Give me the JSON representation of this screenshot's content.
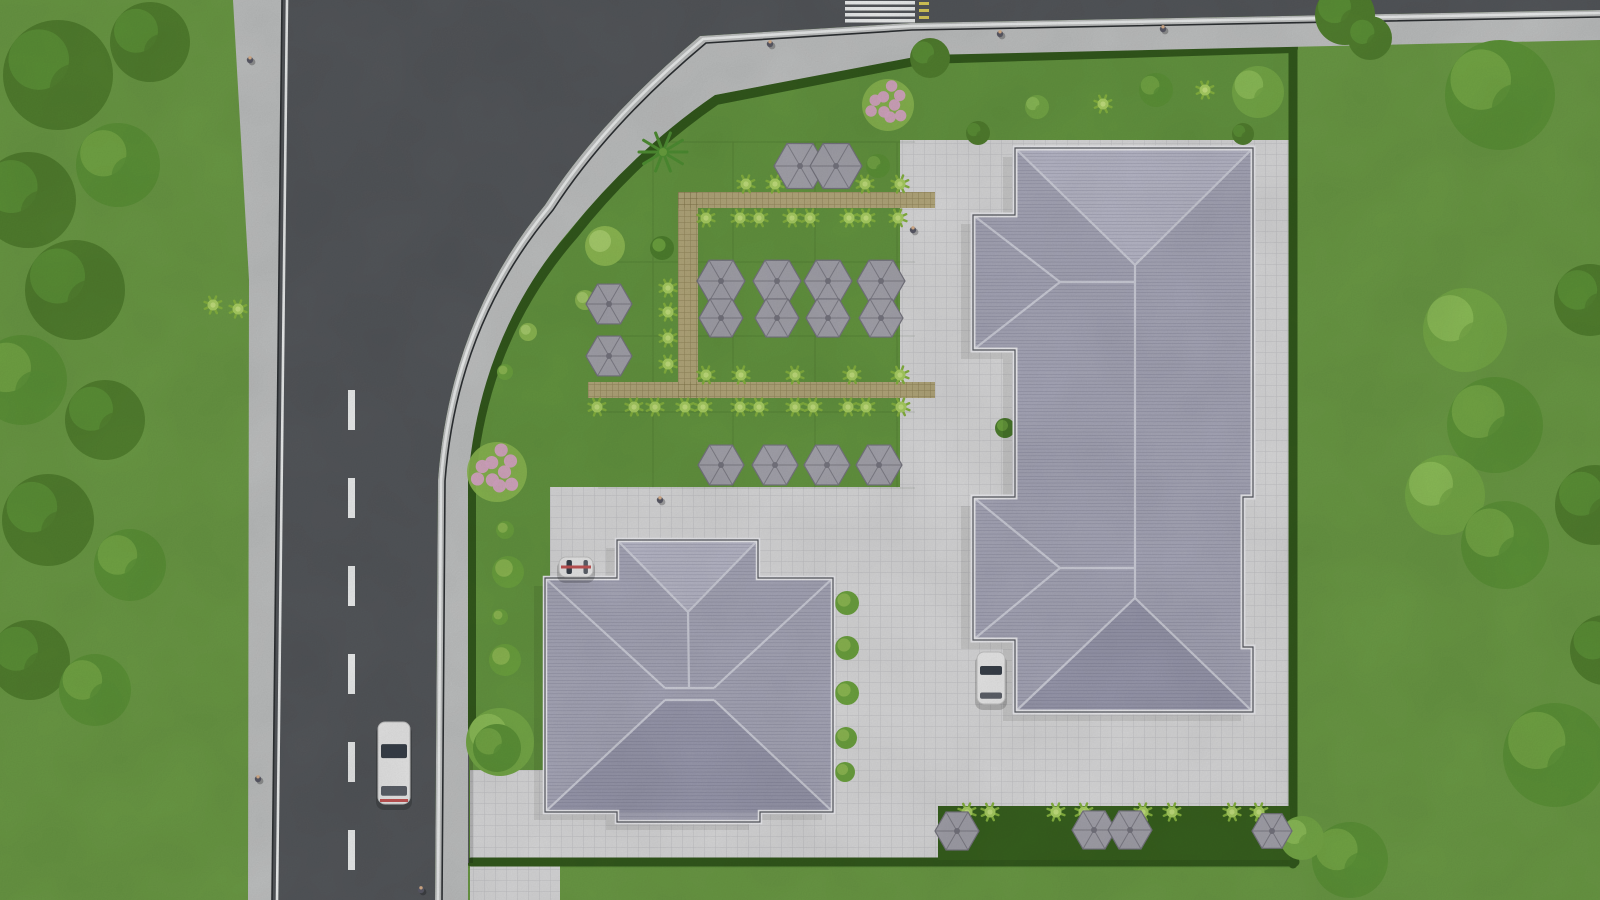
{
  "scene": {
    "description": "Aerial top-down 3D architectural rendering of a residential site plan: an L-shaped asphalt road with sidewalks on the left and top, a hedged property containing a large apartment building (top right), a smaller building (bottom centre), a paved courtyard, a community garden with hexagonal pavilions and boardwalk paths, a planter strip, parked and moving cars, and surrounding lawns with trees.",
    "palette": {
      "baseLawn": "#6b9a45",
      "propertyLawn": "#649540",
      "asphalt": "#54575b",
      "sidewalk": "#bfc1c1",
      "curb": "#2d3033",
      "lineWhite": "#eceeee",
      "lineYellow": "#d9ca5a",
      "hedge": "#33591d",
      "pavement": "#d9d9da",
      "pavementLine": "#c6c6c9",
      "planter": "#38611f",
      "boardwalk": "#b4a87c",
      "boardwalkLine": "#8f845a",
      "roof": "#a8a8b9",
      "roofLight": "#b9b9c9",
      "roofDark": "#9a9aae",
      "roofLine": "#cdced9",
      "eave": "#ebebef",
      "wallLine": "#55575e",
      "hexFill": "#a4a3ac",
      "hexEdge": "#76757f",
      "shrub": "#a9cf63",
      "shrubCore": "#c3e07e",
      "bush": "#6ca23f",
      "bushLight": "#8cb852",
      "tree": "#527f2f",
      "treeMid": "#5d9338",
      "treeLight": "#75a847",
      "pink": "#d9a8c6",
      "fence": "#5a5c60",
      "carBody": "#eaeaea",
      "carGlass": "#39404a",
      "carRed": "#c25555",
      "person": "#5a5a66",
      "personHead": "#d8b08c"
    },
    "counts": {
      "hexagon_pavilions": 20,
      "cars": 3,
      "pedestrians": 8
    },
    "trees": [
      [
        58,
        75,
        55,
        "d"
      ],
      [
        150,
        42,
        40,
        "d"
      ],
      [
        28,
        200,
        48,
        "d"
      ],
      [
        118,
        165,
        42,
        "m"
      ],
      [
        75,
        290,
        50,
        "d"
      ],
      [
        22,
        380,
        45,
        "m"
      ],
      [
        105,
        420,
        40,
        "d"
      ],
      [
        48,
        520,
        46,
        "d"
      ],
      [
        130,
        565,
        36,
        "m"
      ],
      [
        30,
        660,
        40,
        "d"
      ],
      [
        95,
        690,
        36,
        "m"
      ],
      [
        1500,
        95,
        55,
        "m"
      ],
      [
        1345,
        15,
        30,
        "d"
      ],
      [
        1370,
        38,
        22,
        "d"
      ],
      [
        1465,
        330,
        42,
        "l"
      ],
      [
        1495,
        425,
        48,
        "m"
      ],
      [
        1445,
        495,
        40,
        "l"
      ],
      [
        1505,
        545,
        44,
        "m"
      ],
      [
        1590,
        300,
        36,
        "d"
      ],
      [
        1595,
        505,
        40,
        "d"
      ],
      [
        1555,
        755,
        52,
        "m"
      ],
      [
        1605,
        650,
        35,
        "d"
      ],
      [
        1350,
        860,
        38,
        "m"
      ],
      [
        1302,
        838,
        22,
        "l"
      ],
      [
        1156,
        90,
        17,
        "m"
      ],
      [
        1258,
        92,
        26,
        "l"
      ],
      [
        1243,
        134,
        11,
        "d"
      ],
      [
        1037,
        107,
        12,
        "l"
      ],
      [
        978,
        133,
        12,
        "d"
      ],
      [
        930,
        58,
        20,
        "d"
      ],
      [
        878,
        166,
        12,
        "m"
      ],
      [
        500,
        742,
        34,
        "l"
      ],
      [
        497,
        748,
        24,
        "m"
      ]
    ],
    "shrubs": [
      [
        746,
        184
      ],
      [
        775,
        184
      ],
      [
        865,
        184
      ],
      [
        900,
        184
      ],
      [
        706,
        218
      ],
      [
        740,
        218
      ],
      [
        759,
        218
      ],
      [
        792,
        218
      ],
      [
        810,
        218
      ],
      [
        849,
        218
      ],
      [
        866,
        218
      ],
      [
        898,
        218
      ],
      [
        668,
        288
      ],
      [
        668,
        312
      ],
      [
        668,
        338
      ],
      [
        668,
        364
      ],
      [
        706,
        375
      ],
      [
        741,
        375
      ],
      [
        795,
        375
      ],
      [
        852,
        375
      ],
      [
        900,
        375
      ],
      [
        597,
        407
      ],
      [
        634,
        407
      ],
      [
        655,
        407
      ],
      [
        685,
        407
      ],
      [
        703,
        407
      ],
      [
        740,
        407
      ],
      [
        759,
        407
      ],
      [
        795,
        407
      ],
      [
        813,
        407
      ],
      [
        848,
        407
      ],
      [
        866,
        407
      ],
      [
        901,
        407
      ],
      [
        213,
        305
      ],
      [
        238,
        309
      ],
      [
        1103,
        104
      ],
      [
        1205,
        90
      ],
      [
        967,
        812
      ],
      [
        990,
        812
      ],
      [
        1056,
        812
      ],
      [
        1084,
        812
      ],
      [
        1143,
        812
      ],
      [
        1172,
        812
      ],
      [
        1232,
        812
      ],
      [
        1259,
        812
      ]
    ],
    "bushes": [
      [
        605,
        246,
        20,
        "l"
      ],
      [
        662,
        248,
        12,
        "d"
      ],
      [
        1005,
        428,
        10,
        "d"
      ],
      [
        847,
        603,
        12,
        "m"
      ],
      [
        847,
        648,
        12,
        "m"
      ],
      [
        847,
        693,
        12,
        "m"
      ],
      [
        846,
        738,
        11,
        "m"
      ],
      [
        845,
        772,
        10,
        "m"
      ],
      [
        505,
        530,
        9,
        "m"
      ],
      [
        508,
        572,
        16,
        "m"
      ],
      [
        500,
        617,
        8,
        "m"
      ],
      [
        505,
        660,
        16,
        "m"
      ],
      [
        585,
        300,
        10,
        "l"
      ],
      [
        528,
        332,
        9,
        "l"
      ],
      [
        505,
        372,
        8,
        "m"
      ]
    ],
    "pink_bushes": [
      [
        888,
        105,
        26
      ],
      [
        497,
        472,
        30
      ]
    ],
    "palms": [
      [
        663,
        152
      ]
    ],
    "hexagons": [
      [
        800,
        166,
        26
      ],
      [
        836,
        166,
        26
      ],
      [
        721,
        281,
        24
      ],
      [
        721,
        318,
        22
      ],
      [
        777,
        281,
        24
      ],
      [
        777,
        318,
        22
      ],
      [
        828,
        281,
        24
      ],
      [
        828,
        318,
        22
      ],
      [
        881,
        281,
        24
      ],
      [
        881,
        318,
        22
      ],
      [
        609,
        304,
        23
      ],
      [
        609,
        356,
        23
      ],
      [
        721,
        465,
        23
      ],
      [
        775,
        465,
        23
      ],
      [
        827,
        465,
        23
      ],
      [
        879,
        465,
        23
      ],
      [
        957,
        831,
        22
      ],
      [
        1094,
        830,
        22
      ],
      [
        1130,
        830,
        22
      ],
      [
        1272,
        831,
        20
      ]
    ],
    "people": [
      [
        250,
        60
      ],
      [
        770,
        44
      ],
      [
        1000,
        34
      ],
      [
        1163,
        29
      ],
      [
        913,
        230
      ],
      [
        660,
        500
      ],
      [
        258,
        779
      ],
      [
        421,
        890
      ]
    ],
    "cars": [
      {
        "x": 378,
        "y": 722,
        "w": 32,
        "h": 82,
        "orient": "v",
        "accent": true
      },
      {
        "x": 977,
        "y": 652,
        "w": 28,
        "h": 52,
        "orient": "v",
        "accent": false
      },
      {
        "x": 559,
        "y": 557,
        "w": 34,
        "h": 20,
        "orient": "h",
        "accent": true
      }
    ],
    "road": {
      "dash_x": 348,
      "dash_ys": [
        390,
        478,
        566,
        654,
        742,
        830
      ],
      "dash_len": 40,
      "dash_w": 7,
      "crosswalk": {
        "x": 845,
        "w": 70,
        "stripe_ys": [
          1,
          7,
          13,
          19
        ],
        "stripe_h": 3.5,
        "yellow_x": 919,
        "yellow_ys": [
          2,
          9,
          16
        ]
      }
    }
  }
}
